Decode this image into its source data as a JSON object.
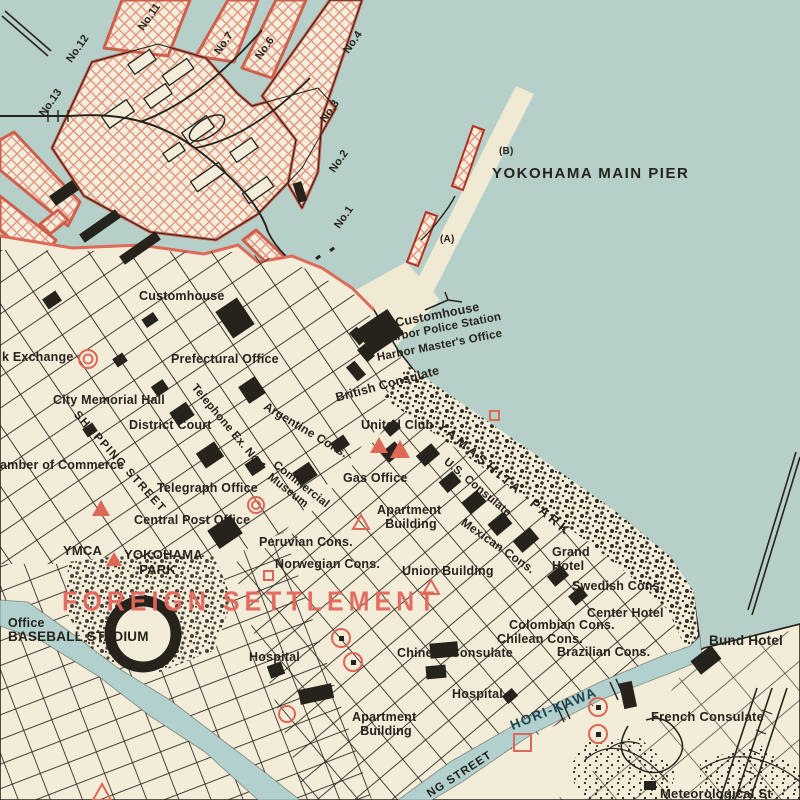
{
  "colors": {
    "water": "#b7cfc9",
    "land": "#f2ecd8",
    "ink": "#26231d",
    "dock_border": "#cf5f4d",
    "hatch_line": "#e29681",
    "red_symbol": "#dd6856",
    "red_text": "#e4685c",
    "canal_text": "#1c4350"
  },
  "map_symbols": {
    "triangle": "red triangle marker (consulate/landmark)",
    "circle": "red circled marker",
    "square": "red square marker"
  },
  "labels": {
    "no11": "No.11",
    "no12": "No.12",
    "no13": "No.13",
    "no7": "No.7",
    "no6": "No.6",
    "no4": "No.4",
    "no3": "No.3",
    "no2": "No.2",
    "no1": "No.1",
    "pier_b": "(B)",
    "main_pier": "YOKOHAMA MAIN PIER",
    "pier_a": "(A)",
    "harbor_l1": "Customhouse",
    "harbor_l2": "Harbor Police Station",
    "harbor_l3": "Harbor Master's Office",
    "british_consulate": "British Consulate",
    "customhouse": "Customhouse",
    "prefectural": "Prefectural Office",
    "exchange": "k Exchange",
    "telephone": "Telephone Ex. No.1",
    "memorial": "City Memorial Hall",
    "shopping": "SHOPPING STREET",
    "district_court": "District Court",
    "commerce": "amber of Commerce",
    "telegraph": "Telegraph Office",
    "central_post": "Central Post Office",
    "ymca": "YMCA",
    "yokohama_park": "YOKOHAMA\n    PARK",
    "argentine": "Argentine Cons.",
    "united_club": "United Club",
    "gas_office": "Gas Office",
    "commercial_museum": "Commercial\n Museum",
    "us_consulate": "U.S. Consulate",
    "yamashita_park": "YAMASHITA  PARK",
    "apartment_n": "Apartment\n Building",
    "mexican": "Mexican Cons.",
    "peruvian": "Peruvian Cons.",
    "norwegian": "Norwegian Cons.",
    "union_building": "Union Building",
    "grand_hotel": "Grand\nHotel",
    "swedish": "Swedish Cons.",
    "center_hotel": "Center Hotel",
    "colombian": "Colombian Cons.",
    "chilean": "Chilean Cons.",
    "brazilian": "Brazilian Cons.",
    "bund_hotel": "Bund Hotel",
    "foreign_settlement": "FOREIGN SETTLEMENT",
    "office": "Office",
    "baseball_stadium": "BASEBALL STADIUM",
    "hospital_w": "Hospital",
    "chinese_consulate": "Chinese Consulate",
    "hospital_e": "Hospital",
    "apartment_s": "Apartment\n Building",
    "hori_kawa": "HORI-KAWA",
    "french_consulate": "French Consulate",
    "meteorological": "Meteorological St",
    "street_fragment": "NG STREET"
  }
}
